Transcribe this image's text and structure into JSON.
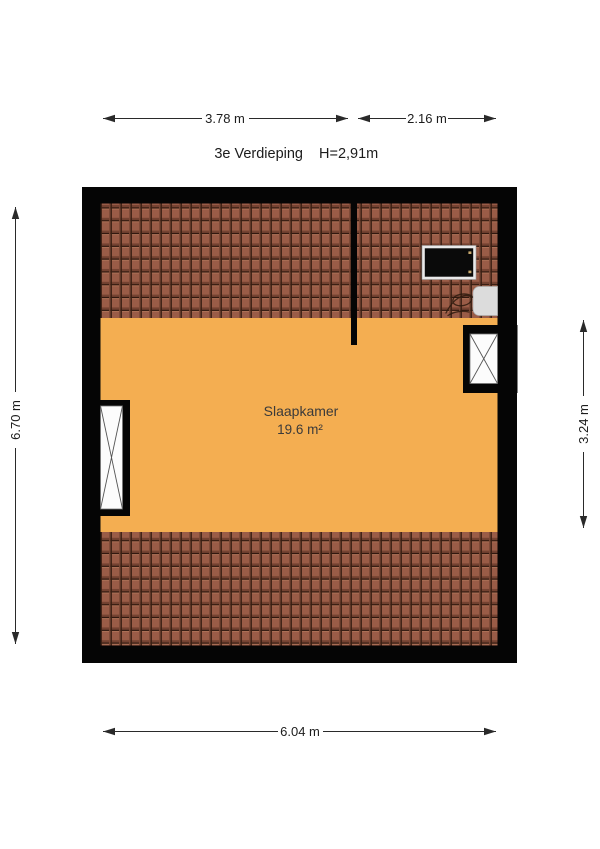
{
  "header": {
    "floor_label": "3e Verdieping",
    "ceiling_height": "H=2,91m"
  },
  "room": {
    "name": "Slaapkamer",
    "area": "19.6 m²"
  },
  "dimensions": {
    "top_left": "3.78 m",
    "top_right": "2.16 m",
    "left": "6.70 m",
    "right": "3.24 m",
    "bottom": "6.04 m"
  },
  "colors": {
    "floor_orange": "#F4AE51",
    "roof_tile_brown": "#9A5C47",
    "wall_black": "#050505",
    "fixture_gray": "#DCDCDC",
    "skylight_frame": "#E9E9E9",
    "skylight_glass": "#0A0A0A",
    "dimension_text": "#1c1c1c"
  }
}
